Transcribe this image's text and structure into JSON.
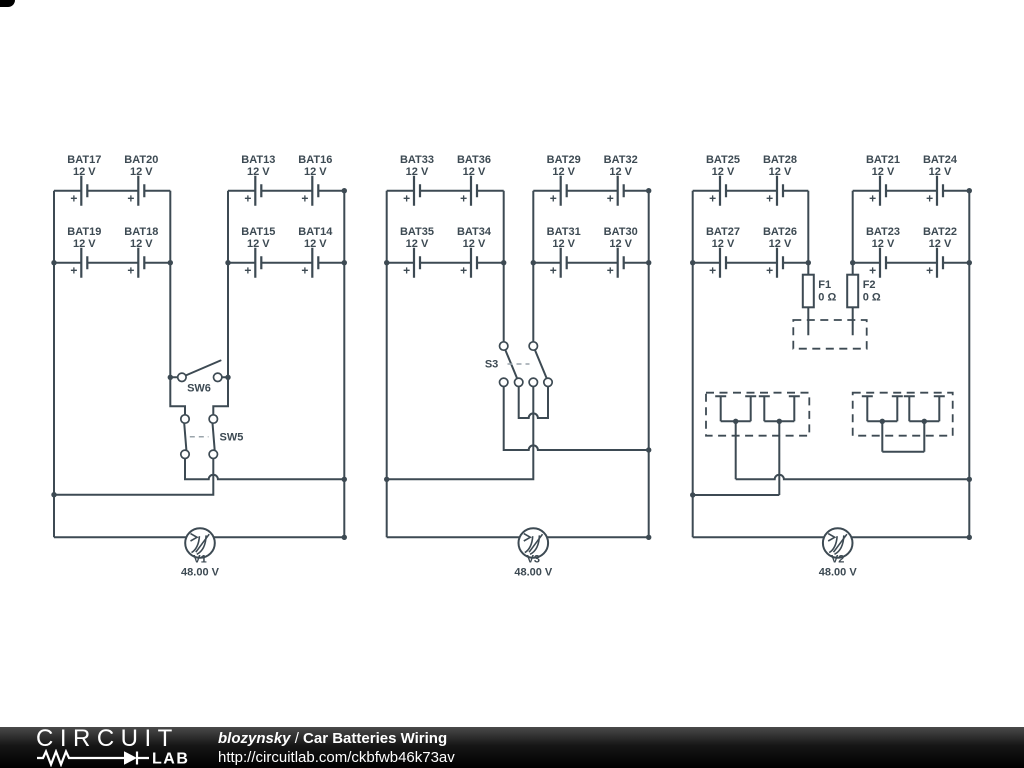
{
  "colors": {
    "wire": "#3d4a53",
    "canvas": "#ffffff",
    "footer_bg": "#000000",
    "footer_text": "#ffffff"
  },
  "symbols": {
    "plus": "+"
  },
  "footer": {
    "logo_line1": "CIRCUIT",
    "logo_line2": "LAB",
    "author": "blozynsky",
    "separator": " / ",
    "title": "Car Batteries Wiring",
    "url": "http://circuitlab.com/ckbfwb46k73av"
  },
  "circuits": [
    {
      "label": "left",
      "batteries": [
        {
          "name": "BAT17",
          "voltage": "12 V"
        },
        {
          "name": "BAT20",
          "voltage": "12 V"
        },
        {
          "name": "BAT13",
          "voltage": "12 V"
        },
        {
          "name": "BAT16",
          "voltage": "12 V"
        },
        {
          "name": "BAT19",
          "voltage": "12 V"
        },
        {
          "name": "BAT18",
          "voltage": "12 V"
        },
        {
          "name": "BAT15",
          "voltage": "12 V"
        },
        {
          "name": "BAT14",
          "voltage": "12 V"
        }
      ],
      "switches": [
        {
          "name": "SW6"
        },
        {
          "name": "SW5"
        }
      ],
      "meter": {
        "name": "V1",
        "value": "48.00 V"
      }
    },
    {
      "label": "middle",
      "batteries": [
        {
          "name": "BAT33",
          "voltage": "12 V"
        },
        {
          "name": "BAT36",
          "voltage": "12 V"
        },
        {
          "name": "BAT29",
          "voltage": "12 V"
        },
        {
          "name": "BAT32",
          "voltage": "12 V"
        },
        {
          "name": "BAT35",
          "voltage": "12 V"
        },
        {
          "name": "BAT34",
          "voltage": "12 V"
        },
        {
          "name": "BAT31",
          "voltage": "12 V"
        },
        {
          "name": "BAT30",
          "voltage": "12 V"
        }
      ],
      "switches": [
        {
          "name": "S3"
        }
      ],
      "meter": {
        "name": "V3",
        "value": "48.00 V"
      }
    },
    {
      "label": "right",
      "batteries": [
        {
          "name": "BAT25",
          "voltage": "12 V"
        },
        {
          "name": "BAT28",
          "voltage": "12 V"
        },
        {
          "name": "BAT21",
          "voltage": "12 V"
        },
        {
          "name": "BAT24",
          "voltage": "12 V"
        },
        {
          "name": "BAT27",
          "voltage": "12 V"
        },
        {
          "name": "BAT26",
          "voltage": "12 V"
        },
        {
          "name": "BAT23",
          "voltage": "12 V"
        },
        {
          "name": "BAT22",
          "voltage": "12 V"
        }
      ],
      "fuses": [
        {
          "name": "F1",
          "value": "0 Ω"
        },
        {
          "name": "F2",
          "value": "0 Ω"
        }
      ],
      "meter": {
        "name": "V2",
        "value": "48.00 V"
      }
    }
  ]
}
